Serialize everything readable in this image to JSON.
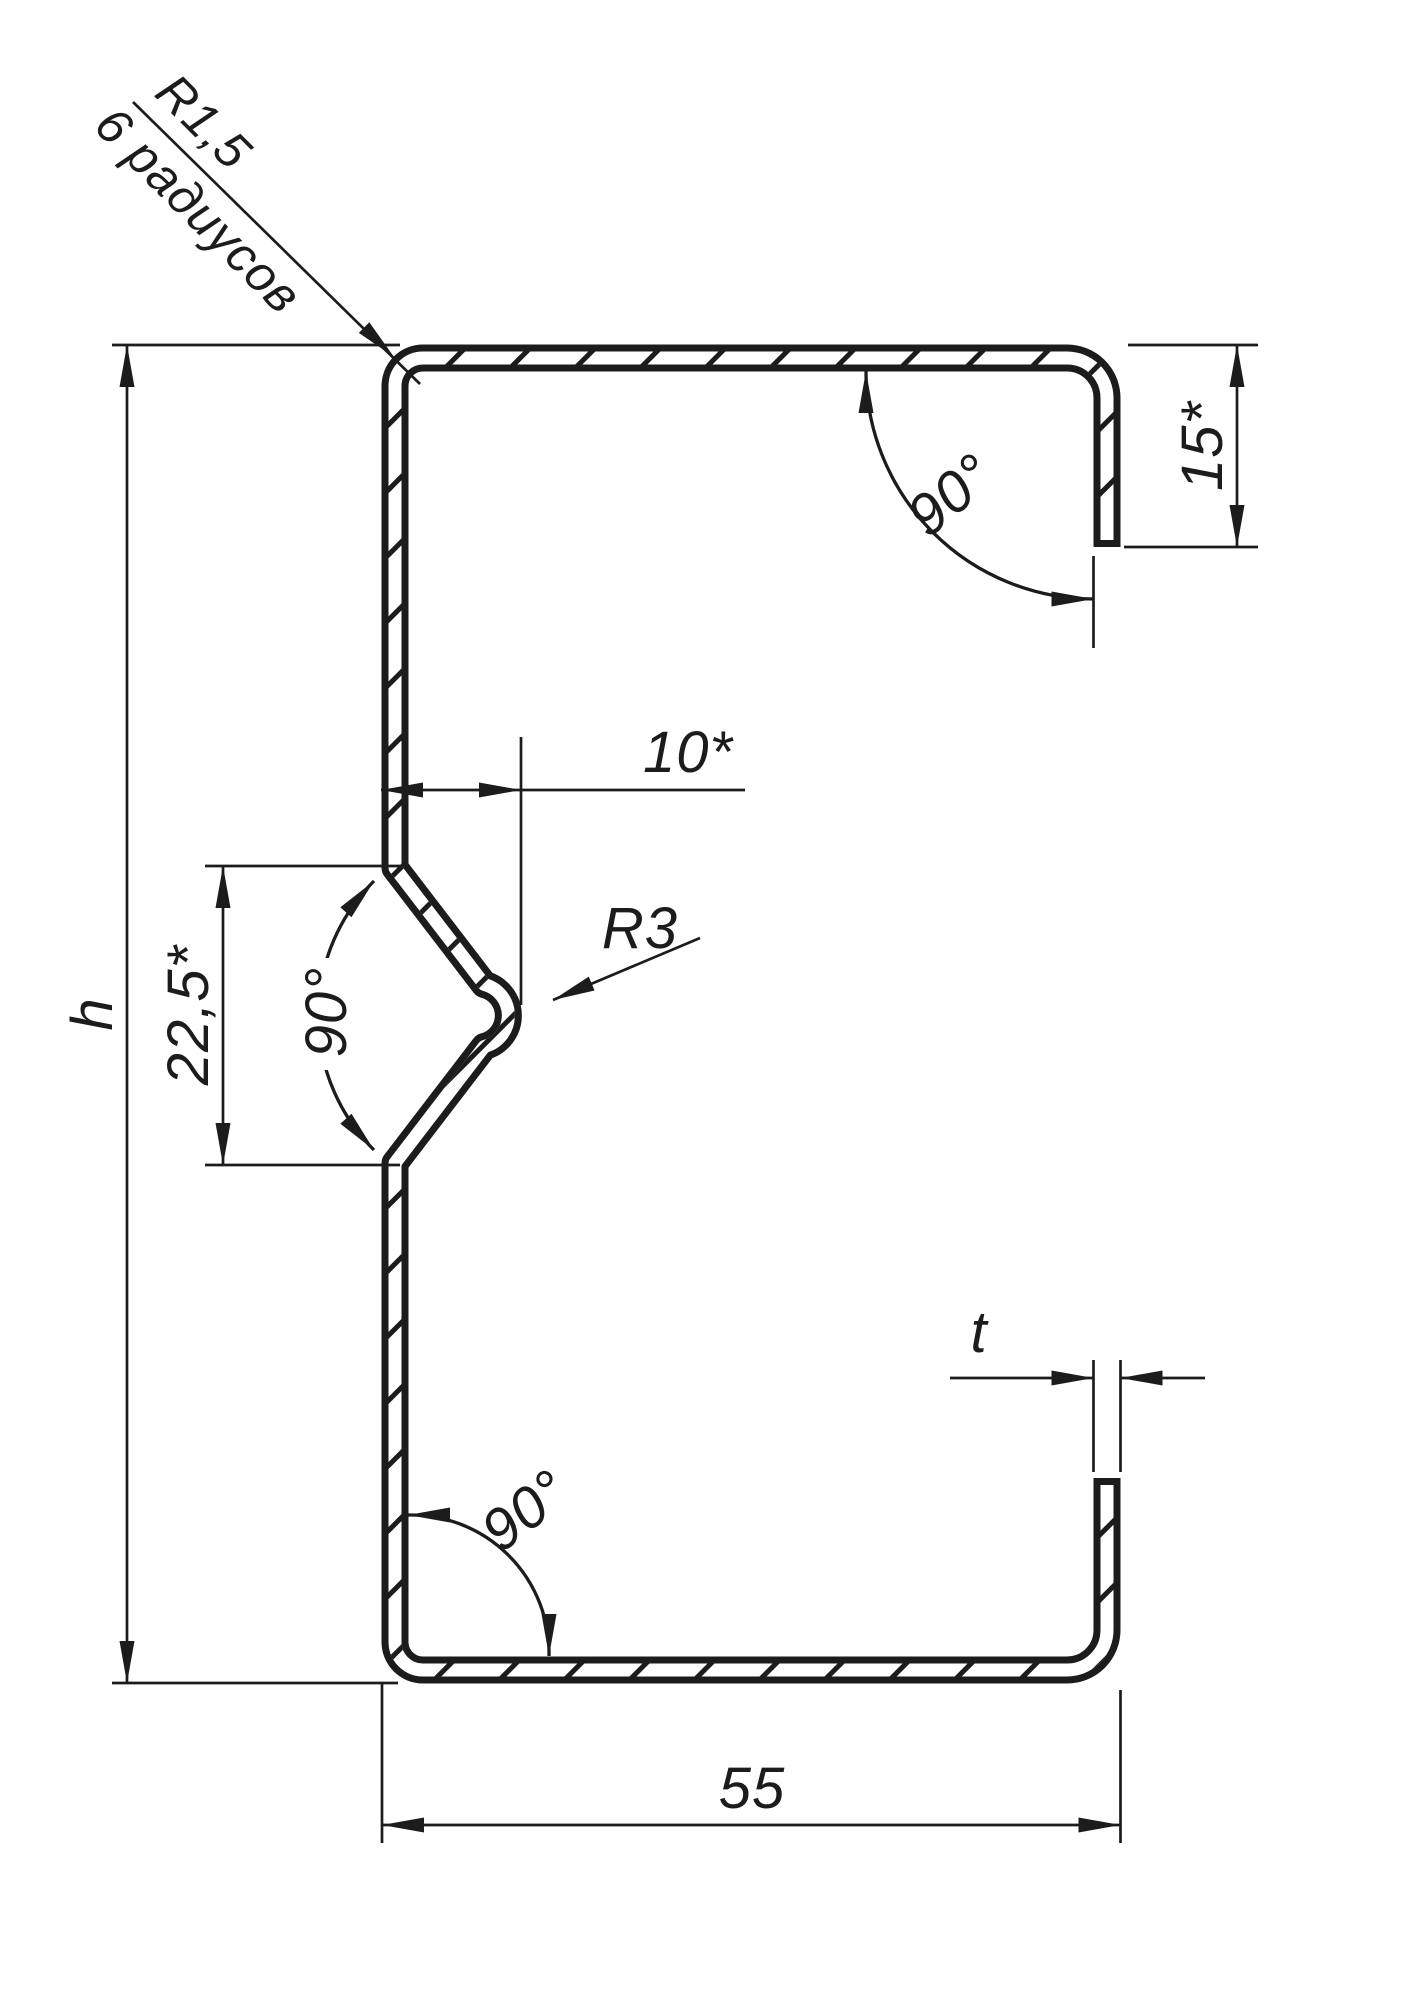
{
  "drawing": {
    "type": "technical-profile-cross-section",
    "background": "#ffffff",
    "line_color": "#1c1c1c",
    "labels": {
      "corner_radius": "R1,5",
      "corner_radius_note": "6 радиусов",
      "angle_top_right": "90°",
      "lip_length": "15*",
      "rib_depth": "10*",
      "rib_radius": "R3",
      "rib_height": "22,5*",
      "angle_rib": "90°",
      "profile_height": "h",
      "angle_bottom_left": "90°",
      "thickness": "t",
      "profile_width": "55"
    }
  }
}
